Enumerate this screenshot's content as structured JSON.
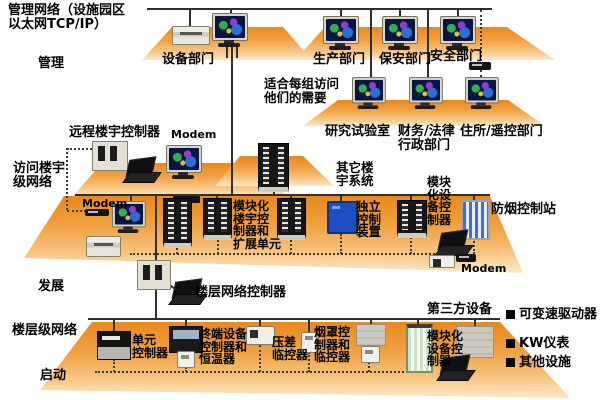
{
  "header": {
    "title": "管理网络（设施园区\n以太网TCP/IP）"
  },
  "stage_labels": {
    "management": "管理",
    "access": "访问楼宇\n级网络",
    "development": "发展",
    "floor": "楼层级网络",
    "startup": "启动"
  },
  "management_tier": {
    "equipment_dept": "设备部门",
    "production_dept": "生产部门",
    "security_dept": "保安部门",
    "safety_dept": "安全部门",
    "note": "适合每组访问\n他们的需要",
    "research_lab": "研究试验室",
    "finance_legal": "财务/法律\n行政部门",
    "residence_remote": "住所/遥控部门"
  },
  "building_tier": {
    "remote_building_controller": "远程楼宇控制器",
    "modem_top": "Modem",
    "modem_left": "Modem",
    "modem_right": "Modem",
    "modular_building_controller": "模块化\n楼宇控\n制器和\n扩展单元",
    "other_building_systems": "其它楼\n宇系统",
    "standalone_control": "独立\n控制\n装置",
    "modular_equipment_controller": "模块\n化设\n备控\n制器",
    "smoke_control_station": "防烟控制站"
  },
  "floor_tier": {
    "floor_network_controller": "楼层网络控制器",
    "third_party_devices": "第三方设备",
    "unit_controller": "单元\n控制器",
    "terminal_controller": "终端设备\n控制器和\n恒温器",
    "pressure_monitor": "压差\n临控器",
    "hood_controller": "烟罩控\n制器和\n临控器",
    "modular_equipment_controller": "模块化\n设备控\n制器"
  },
  "legend": {
    "items": [
      {
        "label": "可变速驱动器"
      },
      {
        "label": "KW仪表"
      },
      {
        "label": "其他设施"
      }
    ]
  },
  "colors": {
    "platform_orange_top": "#E8891C",
    "platform_orange_bottom": "#FCE8C8",
    "line": "#2F2F2F",
    "standalone_box_blue": "#1D4FC0",
    "legend_bullet": "#000000"
  }
}
